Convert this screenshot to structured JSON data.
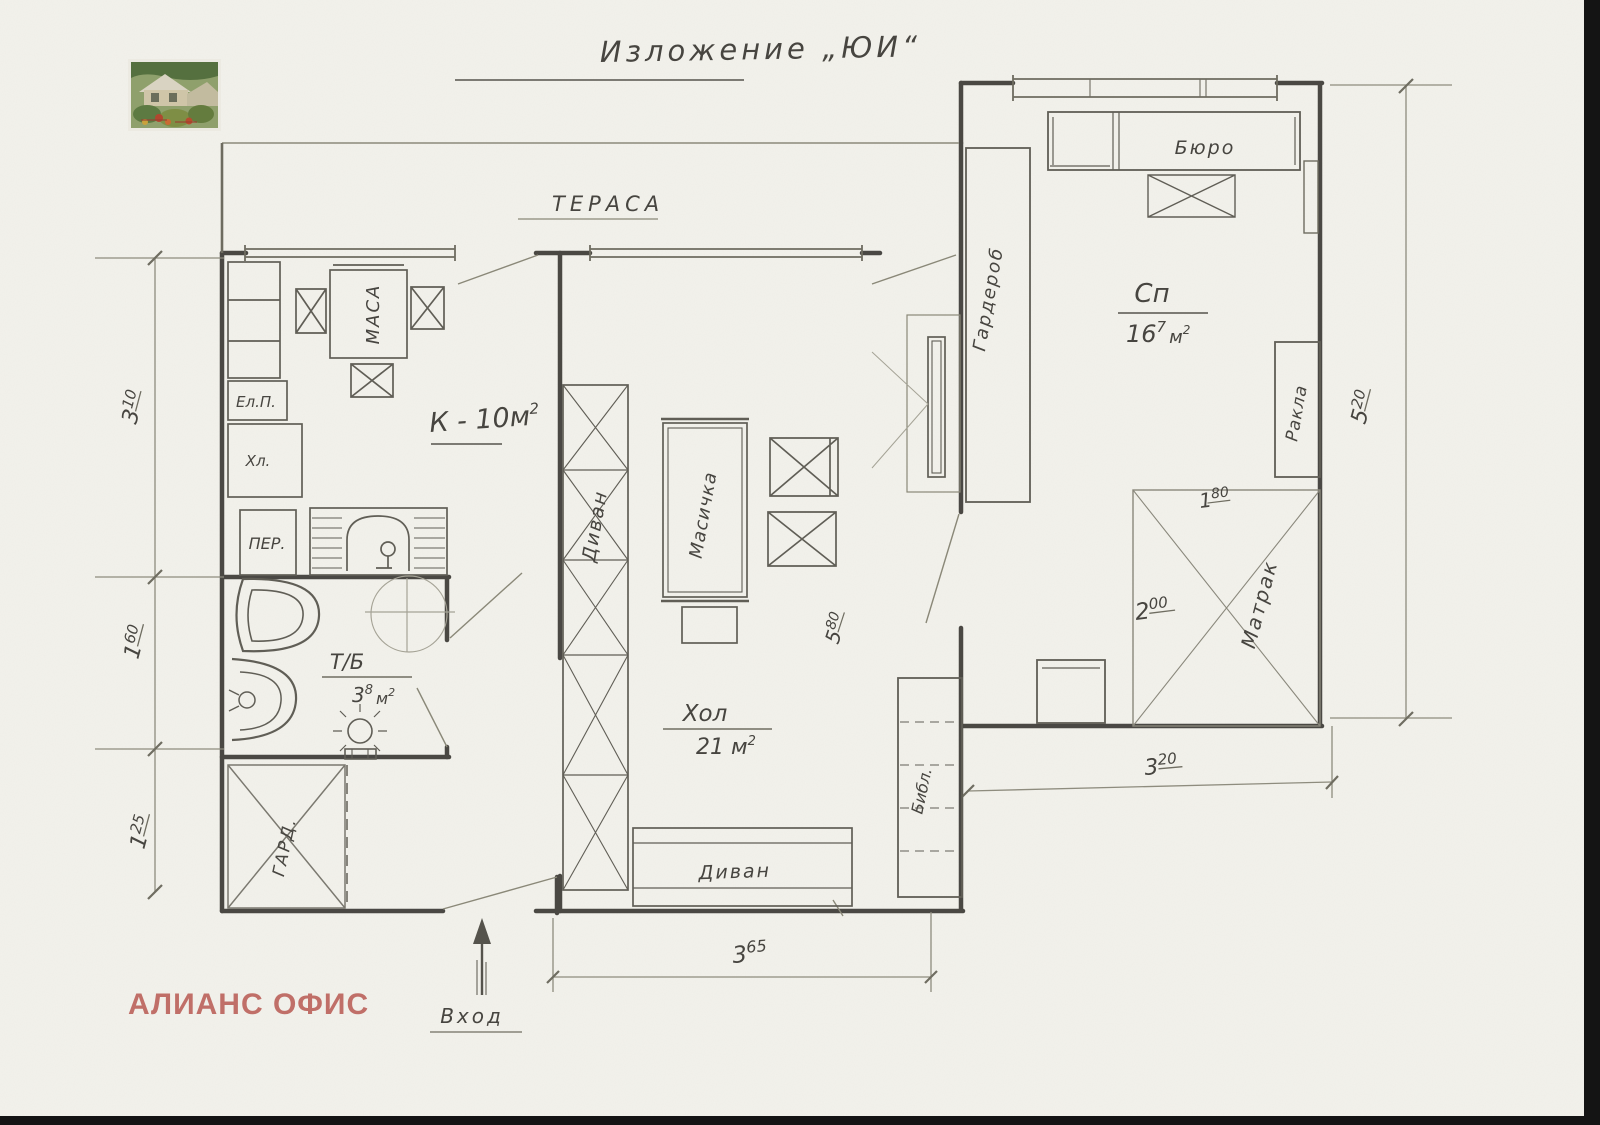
{
  "title": "Изложение „ЮИ“",
  "watermark": "АЛИАНС ОФИС",
  "labels": {
    "terrace": "ТЕРАСА",
    "kitchen_main": "К - 10м",
    "kitchen_sup": "2",
    "hall_name": "Хол",
    "hall_area_main": "21 м",
    "hall_area_sup": "2",
    "bath_name": "Т/Б",
    "bath_area_int": "3",
    "bath_area_dec": "8",
    "bath_area_unit": "м",
    "bath_area_unit_sup": "2",
    "bedroom_name": "Сп",
    "bedroom_area_int": "16",
    "bedroom_area_dec": "7",
    "bedroom_area_unit": "м",
    "bedroom_area_unit_sup": "2",
    "entrance": "Вход"
  },
  "furniture": {
    "table": "МАСА",
    "stove": "Ел.П.",
    "fridge": "Хл.",
    "washer": "ПЕР.",
    "small_wardrobe": "ГАРД.",
    "sofa_left": "Диван",
    "sofa_bottom": "Диван",
    "coffee_table": "Масичка",
    "bookshelf": "Библ.",
    "wardrobe": "Гардероб",
    "desk": "Бюро",
    "chest": "Ракла",
    "mattress": "Матрак"
  },
  "dimensions": {
    "left": [
      {
        "v": "3",
        "s": "10"
      },
      {
        "v": "1",
        "s": "60"
      },
      {
        "v": "1",
        "s": "25"
      }
    ],
    "right": {
      "v": "5",
      "s": "20"
    },
    "bottom": {
      "v": "3",
      "s": "65"
    },
    "bedroom_width": {
      "v": "3",
      "s": "20"
    },
    "hall_depth": {
      "v": "5",
      "s": "80"
    },
    "mattress_width": {
      "v": "1",
      "s": "80"
    },
    "mattress_length": {
      "v": "2",
      "s": "00"
    }
  },
  "colors": {
    "paper": "#f3f2ec",
    "pencil_wall": "#3c3a35",
    "pencil_mid": "#605e56",
    "pencil_thin": "#8e8c7e",
    "watermark": "#c06f68",
    "scan_edge": "#141414"
  }
}
